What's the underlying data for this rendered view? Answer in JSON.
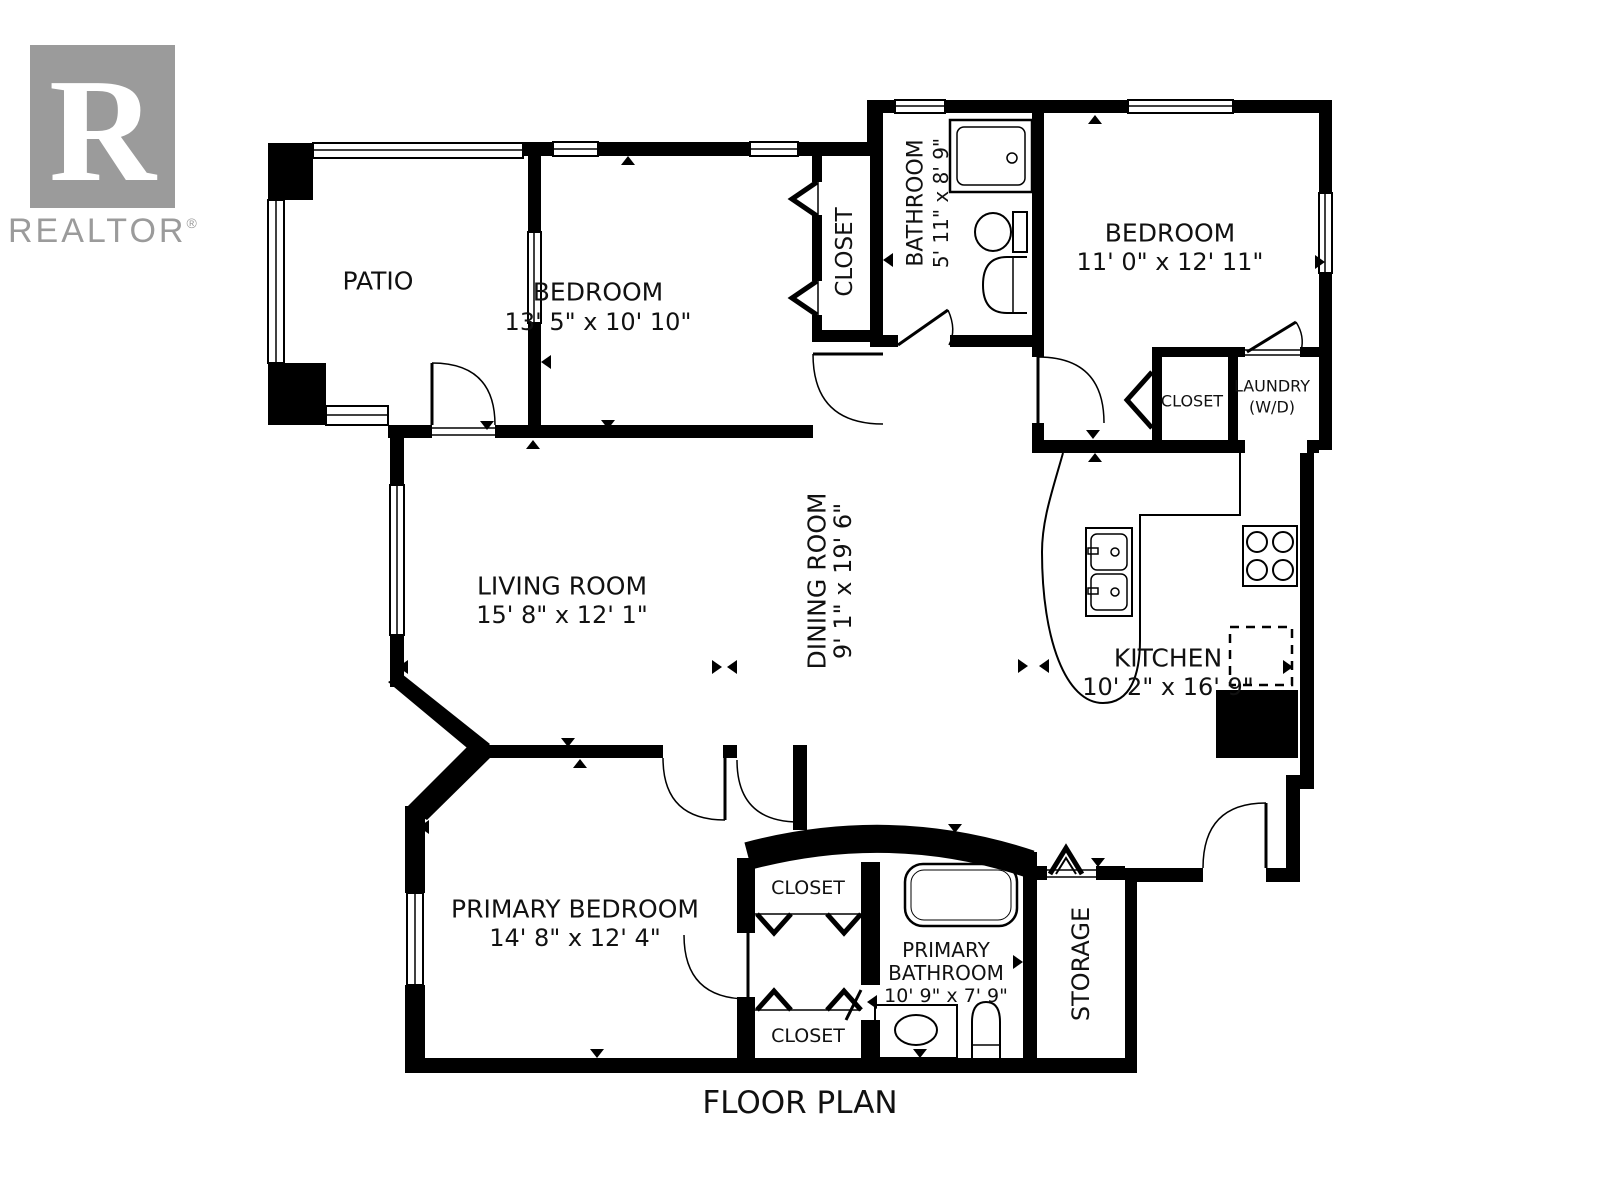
{
  "title": "FLOOR PLAN",
  "branding": {
    "logo_letter": "R",
    "logo_name": "REALTOR",
    "registered": "®"
  },
  "colors": {
    "wall": "#000000",
    "logo_gray": "#9b9b9b",
    "background": "#ffffff"
  },
  "rooms": {
    "patio": {
      "label": "PATIO"
    },
    "bedroom1": {
      "label": "BEDROOM",
      "dims": "13' 5\" x 10' 10\""
    },
    "bedroom1_closet": {
      "label": "CLOSET"
    },
    "bathroom": {
      "label": "BATHROOM",
      "dims": "5' 11\" x 8' 9\""
    },
    "bedroom2": {
      "label": "BEDROOM",
      "dims": "11' 0\" x 12' 11\""
    },
    "bedroom2_closet": {
      "label": "CLOSET"
    },
    "laundry": {
      "label": "LAUNDRY",
      "sub": "(W/D)"
    },
    "living_room": {
      "label": "LIVING ROOM",
      "dims": "15' 8\" x 12' 1\""
    },
    "dining_room": {
      "label": "DINING ROOM",
      "dims": "9' 1\" x 19' 6\""
    },
    "kitchen": {
      "label": "KITCHEN",
      "dims": "10' 2\" x 16' 9\""
    },
    "primary_bedroom": {
      "label": "PRIMARY BEDROOM",
      "dims": "14' 8\" x 12' 4\""
    },
    "primary_closet_upper": {
      "label": "CLOSET"
    },
    "primary_closet_lower": {
      "label": "CLOSET"
    },
    "primary_bathroom": {
      "line1": "PRIMARY",
      "line2": "BATHROOM",
      "dims": "10' 9\" x 7' 9\""
    },
    "storage": {
      "label": "STORAGE"
    }
  }
}
